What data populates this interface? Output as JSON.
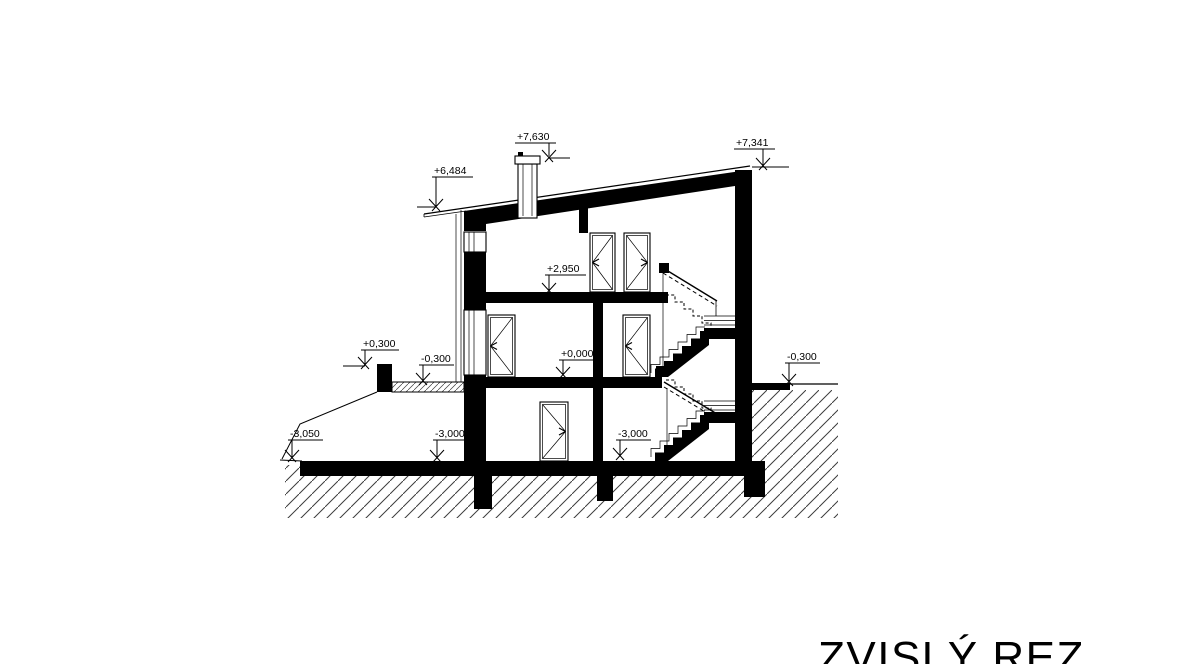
{
  "title": "ZVISLÝ REZ",
  "levels": {
    "chimney_top": "+7,630",
    "eave_left": "+6,484",
    "roof_right": "+7,341",
    "upper_floor": "+2,950",
    "parapet_left": "+0,300",
    "terrace_left": "-0,300",
    "ground_floor": "+0,000",
    "terrain_right": "-0,300",
    "terrain_left": "-3,050",
    "basement_floor_a": "-3,000",
    "basement_floor_b": "-3,000"
  }
}
